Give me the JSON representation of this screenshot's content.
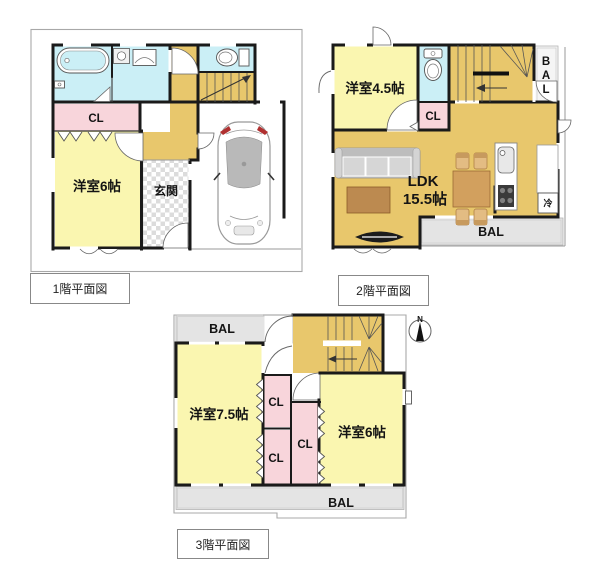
{
  "colors": {
    "room_yellow": "#FAF6B0",
    "hall_tan": "#E8C76C",
    "closet_pink": "#F8D5DB",
    "wet_cyan": "#CBEFF6",
    "balcony_gray": "#E4E4E4",
    "wall_black": "#1A1A1A",
    "wood_table": "#D2A05E",
    "wood_chair": "#E3BC83",
    "coffee_table": "#BC8A50",
    "sofa_gray": "#C9C9C9",
    "car_roof": "#B9B9B9",
    "accent_red": "#B03030"
  },
  "floor1": {
    "caption": "1階平面図",
    "western_room": "洋室6帖",
    "entrance": "玄関",
    "closet": "CL"
  },
  "floor2": {
    "caption": "2階平面図",
    "western_room": "洋室4.5帖",
    "ldk": "LDK",
    "ldk_size": "15.5帖",
    "closet": "CL",
    "balcony_side_letters": [
      "B",
      "A",
      "L"
    ],
    "balcony_bottom": "BAL",
    "refrigerator": "冷"
  },
  "floor3": {
    "caption": "3階平面図",
    "western_room_left": "洋室7.5帖",
    "western_room_right": "洋室6帖",
    "closets": [
      "CL",
      "CL",
      "CL"
    ],
    "balcony_top": "BAL",
    "balcony_bottom": "BAL",
    "compass_north": "N"
  }
}
